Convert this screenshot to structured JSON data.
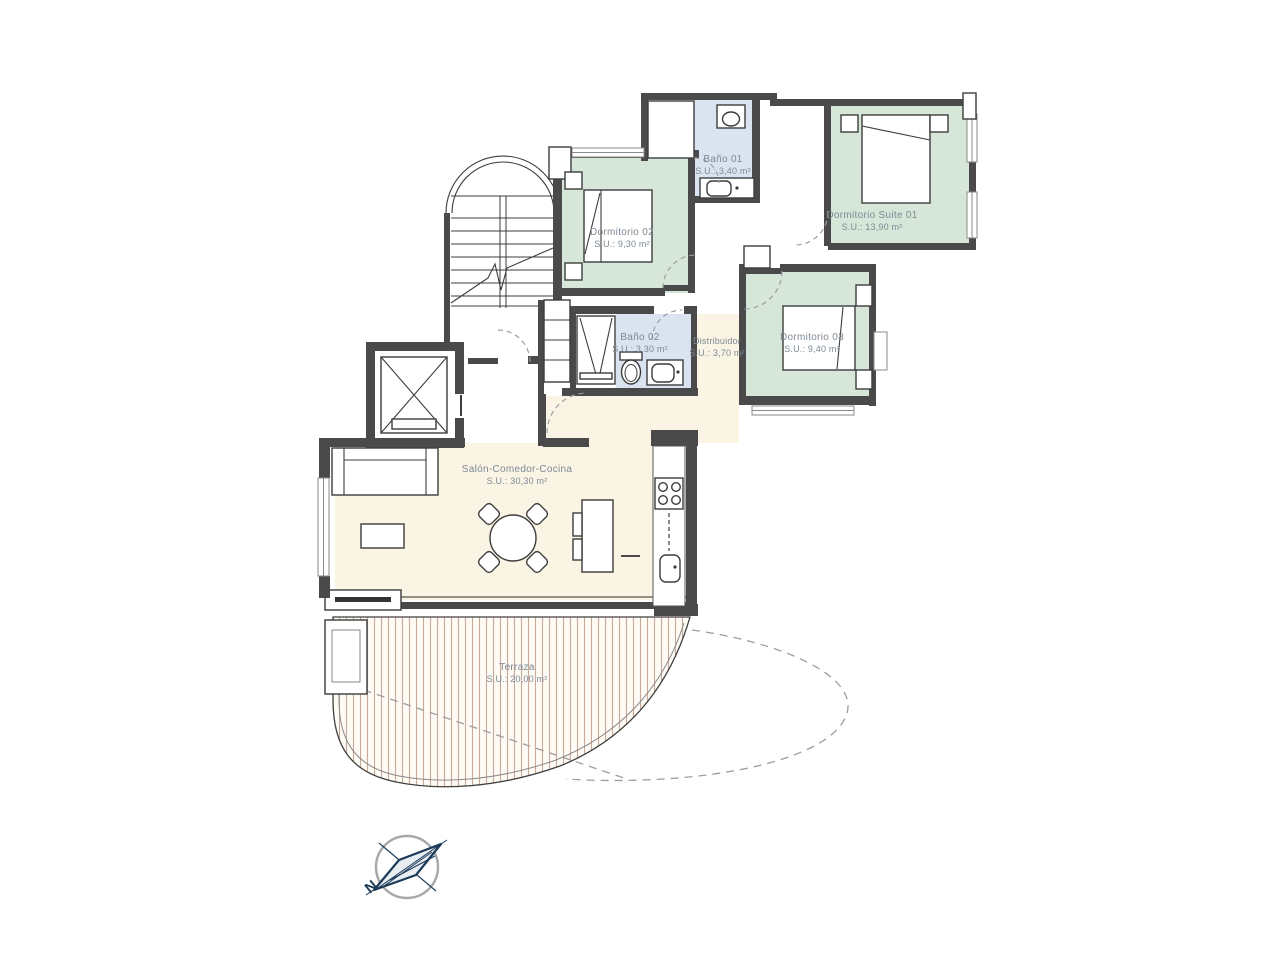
{
  "plan_title": "Apartment floor plan",
  "rooms": {
    "bano01": {
      "name": "Baño 01",
      "area": "S.U.: 3,40 m²"
    },
    "suite01": {
      "name": "Dormitorio Suite 01",
      "area": "S.U.: 13,90 m²"
    },
    "dorm02": {
      "name": "Dormitorio 02",
      "area": "S.U.: 9,30 m²"
    },
    "bano02": {
      "name": "Baño 02",
      "area": "S.U.: 3,30 m²"
    },
    "distribuidor": {
      "name": "Distribuidor",
      "area": "S.U.: 3,70 m²"
    },
    "dorm03": {
      "name": "Dormitorio 03",
      "area": "S.U.: 9,40 m²"
    },
    "salon": {
      "name": "Salón-Comedor-Cocina",
      "area": "S.U.: 30,30 m²"
    },
    "terraza": {
      "name": "Terraza",
      "area": "S.U.: 20,00 m²"
    }
  },
  "compass": {
    "north_label": "N",
    "needle_color": "#1b3a57"
  },
  "colors": {
    "bedroom_green": "#d6e7d9",
    "bath_blue": "#dae4f0",
    "living_cream": "#faf4e4",
    "terrace_base": "#fdfbf4",
    "terrace_stripe": "#c9aa9a",
    "wall_gray": "#4a4a4a"
  }
}
